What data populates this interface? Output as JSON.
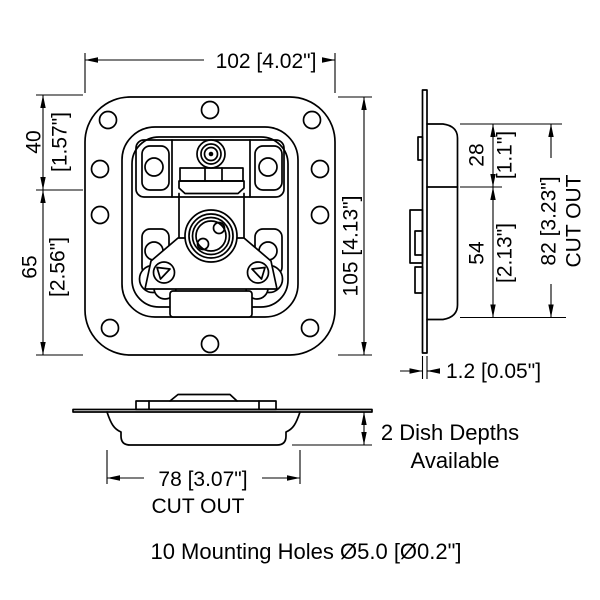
{
  "drawing": {
    "front_view": {
      "width_dim": "102 [4.02\"]",
      "height_dim": "105 [4.13\"]",
      "upper_left_dim_mm": "40",
      "upper_left_dim_in": "[1.57\"]",
      "lower_left_dim_mm": "65",
      "lower_left_dim_in": "[2.56\"]"
    },
    "side_view": {
      "upper_dim_mm": "28",
      "upper_dim_in": "[1.1\"]",
      "lower_dim_mm": "54",
      "lower_dim_in": "[2.13\"]",
      "cutout_dim": "82 [3.23\"]",
      "cutout_label": "CUT OUT",
      "thickness_dim": "1.2 [0.05\"]"
    },
    "bottom_view": {
      "cutout_dim": "78 [3.07\"]",
      "cutout_label": "CUT OUT",
      "depth_note_line1": "2 Dish Depths",
      "depth_note_line2": "Available"
    },
    "footnote": "10 Mounting Holes Ø5.0 [Ø0.2\"]"
  }
}
